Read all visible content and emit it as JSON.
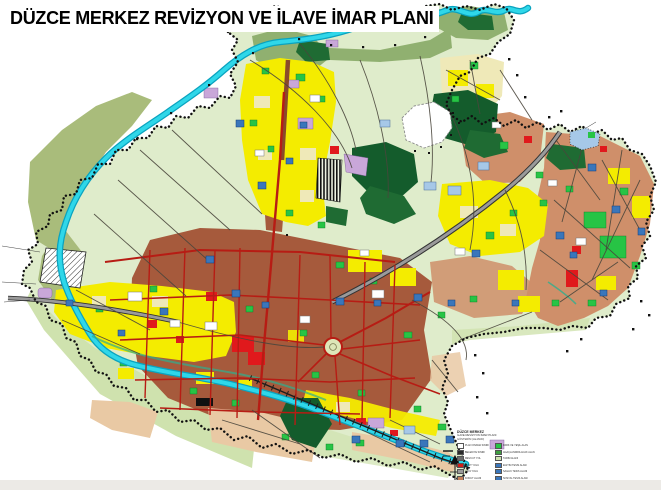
{
  "title": "DÜZCE MERKEZ REVİZYON VE İLAVE İMAR PLANI",
  "legend": {
    "title1": "DÜZCE MERKEZ",
    "title2": "İLAVE REVİZYON İMAR PLANI",
    "title3": "GÖSTERİM (LEJAND)",
    "left": [
      {
        "color": "#ffffff",
        "label": "PLAN ONAMA SINIRI"
      },
      {
        "color": "#2b2b2b",
        "label": "BELEDİYE SINIRI"
      },
      {
        "color": "#6b6b6b",
        "label": "MEVCUT YOL"
      },
      {
        "color": "#d21f1a",
        "label": "TAŞIT YOLU"
      },
      {
        "color": "#9a9a9a",
        "label": "YAYA YOLU"
      },
      {
        "color": "#c4805a",
        "label": "KONUT ALANI"
      },
      {
        "color": "#8a4a2e",
        "label": "TİCARET ALANI"
      }
    ],
    "right": [
      {
        "color": "#27c445",
        "label": "PARK VE YEŞİL ALAN"
      },
      {
        "color": "#3f9e3f",
        "label": "AĞAÇLANDIRILACAK ALAN"
      },
      {
        "color": "#cfe3b0",
        "label": "TARIM ALANI"
      },
      {
        "color": "#3a76bb",
        "label": "EĞİTİM TESİS ALANI"
      },
      {
        "color": "#3a76bb",
        "label": "SAĞLIK TESİS ALANI"
      },
      {
        "color": "#3a76bb",
        "label": "SOSYAL TESİS ALANI"
      },
      {
        "color": "#3a76bb",
        "label": "RESMİ KURUM ALANI"
      },
      {
        "color": "#174a85",
        "label": "TEKNİK ALTYAPI ALANI"
      }
    ]
  },
  "palette": {
    "paleGreen": "#dfeccb",
    "tintGreen": "#cfe2ae",
    "oliveGreen": "#a9bc7b",
    "midGreen": "#90b070",
    "parkGreen": "#27c445",
    "darkGreen": "#1f6b33",
    "forestGreen": "#145c2c",
    "river": "#2fd7e9",
    "riverDeep": "#0aa3bf",
    "brown": "#a65a3c",
    "brownDark": "#8a4a2e",
    "salmon": "#cf8f6a",
    "peach": "#e9c9a4",
    "yellow": "#f4ec00",
    "cream": "#efe9b8",
    "red": "#e0191c",
    "lavender": "#c9a7d9",
    "blue": "#3a76bb",
    "blueDark": "#174a85",
    "lightBlue": "#a6c8e8",
    "roadRed": "#b71c14",
    "roadGray": "#9a9a9a",
    "railBlack": "#1c1c1c",
    "boundary": "#111111",
    "white": "#ffffff"
  }
}
